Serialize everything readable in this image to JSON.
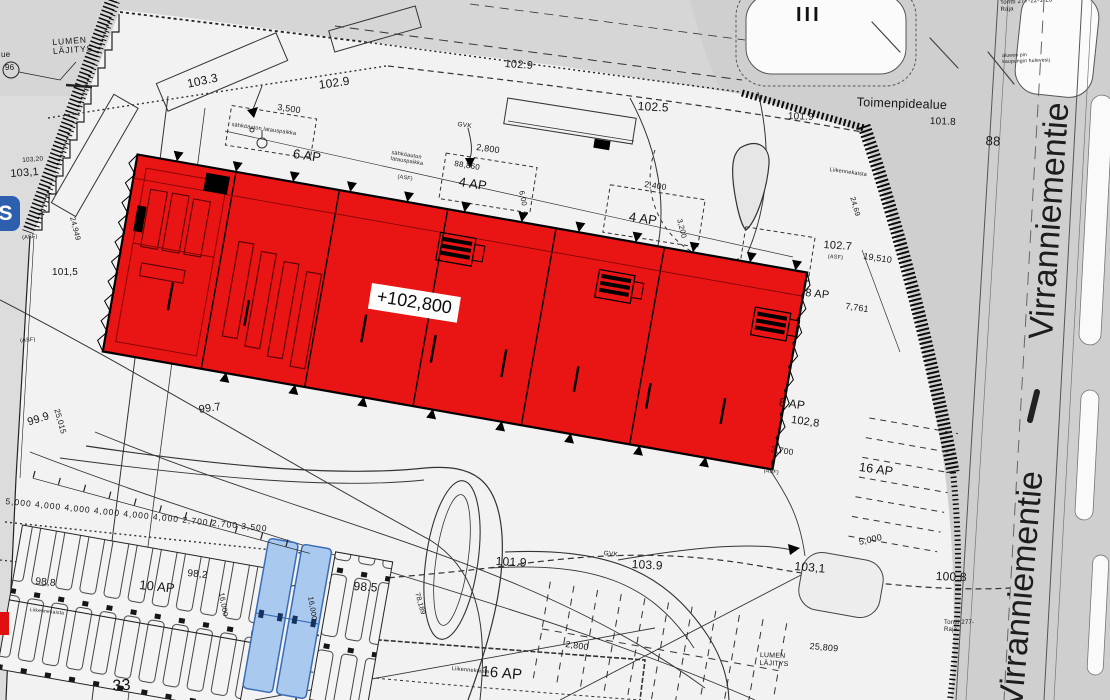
{
  "building": {
    "level_label": "+102,800",
    "floors_roman": "III"
  },
  "streets": {
    "virranniementie_upper": "Virranniementie",
    "virranniementie_lower": "Virranniementie"
  },
  "areas": {
    "snow_storage": "LUMEN\nLÄJITYS",
    "operation_area": "Toimenpidealue"
  },
  "parking_labels": {
    "ap6": "6 AP",
    "ap4_a": "4 AP",
    "ap4_b": "4 AP",
    "ap8_a": "8 AP",
    "ap8_b": "8 AP",
    "ap10": "10 AP",
    "ap16_a": "16 AP",
    "ap16_b": "16 AP"
  },
  "elevations": {
    "e103_3": "103.3",
    "e102_9_a": "102.9",
    "e102_9_b": "102.9",
    "e102_5": "102.5",
    "e101_9_a": "101.9",
    "e101_8": "101.8",
    "e102_7": "102.7",
    "e103_20": "103,20",
    "e103_1_left": "103,1",
    "e101_5": "101,5",
    "e99_9": "99.9",
    "e99_7": "99.7",
    "e98_8": "98,8",
    "e98_2": "98,2",
    "e98_5": "98.5",
    "e101_9_b": "101.9",
    "e103_9": "103.9",
    "e103_1_right": "103,1",
    "e100_8": "100.8",
    "e102_8": "102,8",
    "n96": "96",
    "n88": "88",
    "n33": "33"
  },
  "dimensions": {
    "d3500": "3,500",
    "d2800_a": "2,800",
    "d2800_b": "2,800",
    "d2400": "2,400",
    "d88860": "88,860",
    "d6_00": "6,00",
    "d3200": "3,200",
    "d24_69": "24,69",
    "d19510": "19,510",
    "d7761": "7,761",
    "d24949": "24,949",
    "d25015": "25,015",
    "d16000_a": "16,000",
    "d16000_b": "16,000",
    "d78189": "78,189",
    "d5000": "5,000",
    "d25809": "25,809",
    "d3700": "3,700",
    "chain_left": "5,000 4,000 4,000 4,000 4,000 4,000 2,700 2,700 3,500"
  },
  "notes": {
    "gvk": "GVK",
    "asf": "(ASF)",
    "liikennekaista": "Liikennekaista",
    "latauspaikka": "sähköauton latauspaikka",
    "tontti_raja_top": "Tontti 277-22-1-23\nRaja",
    "tontti_raja_right": "Tontti 277-\nRaja",
    "hulevesi": "alueen pin\nkaupungin hulevesij",
    "partial_ue": "ue",
    "s_logo": "S"
  },
  "colors": {
    "building_red": "#e91414",
    "stall_blue": "#a9c9ef",
    "paper_light": "#f2f2f2",
    "road_gray": "#cfcfcf",
    "line": "#222222"
  }
}
